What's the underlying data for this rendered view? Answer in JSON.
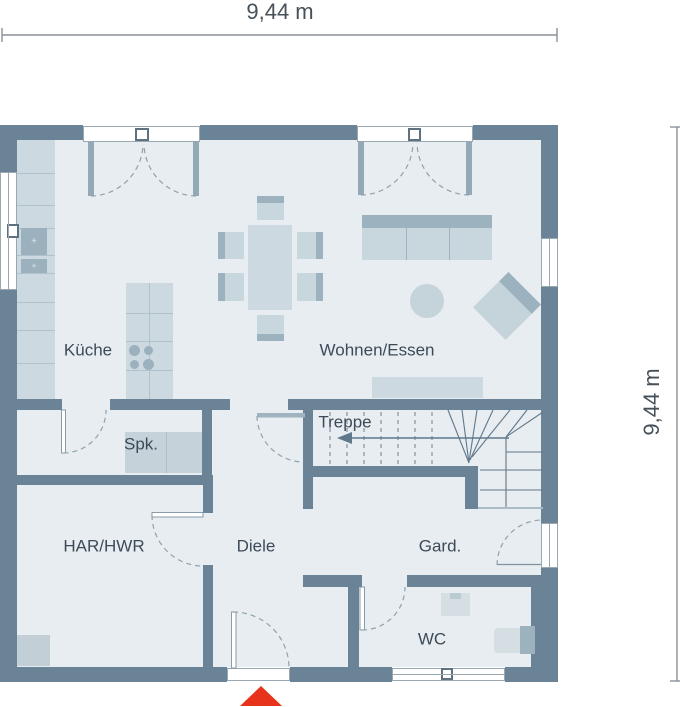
{
  "plan_title": "Erdgeschoss Grundriss",
  "dimensions": {
    "width": {
      "label": "9,44 m"
    },
    "height": {
      "label": "9,44 m"
    }
  },
  "rooms": {
    "kueche": {
      "label": "Küche"
    },
    "wohnen_essen": {
      "label": "Wohnen/Essen"
    },
    "spk": {
      "label": "Spk."
    },
    "treppe": {
      "label": "Treppe"
    },
    "har_hwr": {
      "label": "HAR/HWR"
    },
    "diele": {
      "label": "Diele"
    },
    "gard": {
      "label": "Gard."
    },
    "wc": {
      "label": "WC"
    }
  },
  "icons": {
    "entrance_marker": "red-triangle-up",
    "stair_direction": "arrow-left"
  },
  "colors": {
    "wall": "#6b8396",
    "floor": "#e7edf0",
    "furniture_light": "#ccd9e0",
    "furniture_mid": "#9cb2bf",
    "outline": "#7d93a2",
    "text": "#3d4b59",
    "entrance_red": "#e8331c"
  }
}
